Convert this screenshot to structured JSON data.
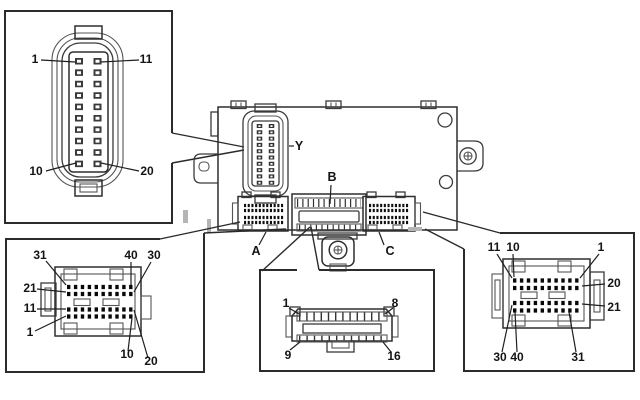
{
  "diagram": {
    "module_connector_labels": {
      "y": "Y",
      "b": "B",
      "a": "A",
      "c": "C"
    },
    "callout_top_left": {
      "pins": {
        "p1": "1",
        "p11": "11",
        "p10": "10",
        "p20": "20"
      }
    },
    "callout_bottom_left": {
      "pins": {
        "p31": "31",
        "p40": "40",
        "p30": "30",
        "p21": "21",
        "p11": "11",
        "p1": "1",
        "p10": "10",
        "p20": "20"
      }
    },
    "callout_bottom_center": {
      "pins": {
        "p1": "1",
        "p8": "8",
        "p9": "9",
        "p16": "16"
      }
    },
    "callout_bottom_right": {
      "pins": {
        "p11": "11",
        "p10": "10",
        "p1": "1",
        "p20": "20",
        "p21": "21",
        "p30": "30",
        "p40": "40",
        "p31": "31"
      }
    },
    "colors": {
      "line": "#2b2b2b",
      "pin": "#0d0d0d",
      "background": "#ffffff"
    }
  }
}
